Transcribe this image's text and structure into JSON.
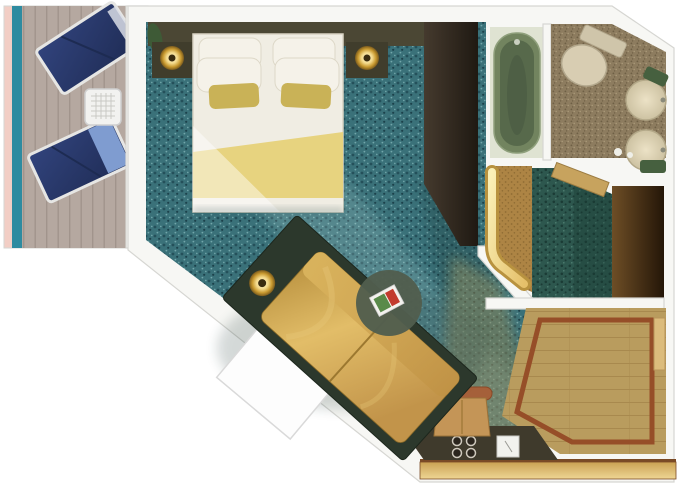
{
  "meta": {
    "title": "Cruise ship stateroom floor plan (top-down rendering)",
    "view": "top-down",
    "text_visible_in_image": ""
  },
  "areas": {
    "balcony": {
      "label": "Balcony",
      "items": [
        "lounge-chair",
        "lounge-chair",
        "mesh-side-table",
        "railing",
        "sliding-door"
      ]
    },
    "bedroom": {
      "label": "Bedroom",
      "items": [
        "double-bed",
        "pillows",
        "gold-runner",
        "nightstand-left",
        "nightstand-right",
        "lamp-left",
        "lamp-right",
        "plant",
        "wardrobe",
        "sofa",
        "side-lamp",
        "round-coffee-table",
        "magazine",
        "white-fold-panel"
      ]
    },
    "bathroom": {
      "label": "Bathroom",
      "items": [
        "bathtub",
        "toilet",
        "sink",
        "sink",
        "green-counter",
        "door-threshold"
      ]
    },
    "dressing": {
      "label": "Dressing area",
      "items": [
        "illuminated-closet",
        "dark-wardrobe"
      ]
    },
    "foyer": {
      "label": "Entry foyer",
      "items": [
        "wood-floor-inlay",
        "entry-door",
        "vanity-desk",
        "desk-chair",
        "cups",
        "note-card"
      ]
    }
  },
  "palette": {
    "wall-stroke": "#d6d6d2",
    "balcony-rail": "#f2cec5",
    "balcony-teal": "#2e8ba0",
    "deck": "#b5a8a0",
    "deck-line": "#a1948c",
    "lounger-navy": "#31437c",
    "lounger-navy-dark": "#1f2c55",
    "lounger-light": "#7f9cd0",
    "lounger-frame": "#e6e6e4",
    "table-white": "#f2f2f0",
    "table-grid": "#c9c9c5",
    "carpet-teal": "#3a7179",
    "carpet-dark": "#24505a",
    "carpet-dark2": "#1c424c",
    "carpet-light": "#72a6aa",
    "corridor-base": "#2d574e",
    "corridor-dark": "#1b3b35",
    "corridor-light": "#4f7f72",
    "headboard": "#4b4734",
    "nightstand": "#403d2c",
    "lamp-center": "#3a2c10",
    "bed-white": "#f0ede3",
    "bed-stroke": "#d9d4c4",
    "blanket-gold": "#e7d37f",
    "pillow-white": "#f5f2e9",
    "pillow-stroke": "#ddd8c8",
    "pillow-gold": "#c9b257",
    "plant": "#3e5a36",
    "wardrobe1-a": "#453a2e",
    "wardrobe1-b": "#1f1912",
    "sofa-base": "#2c382c",
    "table-round": "#515e4e",
    "magazine-red": "#c23b2e",
    "magazine-green": "#5a8a4a",
    "panel-white": "#fdfdfd",
    "panel-stroke": "#d9d9d9",
    "tub-room": "#dfe3d2",
    "tub-outer": "#72845f",
    "tub-inner": "#57694b",
    "tub-rim": "#8fa07c",
    "mosaic-base": "#8d7c5f",
    "mosaic-dark": "#6e5f45",
    "mosaic-light": "#a99877",
    "toilet-body": "#d8cdb2",
    "toilet-stroke": "#b2a78c",
    "sink-edge": "#b3a888",
    "counter-green": "#46603f",
    "threshold-wood": "#c7a35e",
    "threshold-edge": "#9c7c42",
    "closet-cork": "#ad8444",
    "closet-cork-dot": "#8f6c33",
    "wardrobe2-a": "#6e4e26",
    "wardrobe2-b": "#241608",
    "foyer-wood": "#b99c5e",
    "foyer-grain": "#a8894e",
    "inlay-red": "#964e28",
    "band-edge": "#7a4a26",
    "desk-dark": "#3f3a2c",
    "chair-seat": "#c49557",
    "chair-back": "#a5603a",
    "door-tan": "#dcbc7c",
    "door-tan-edge": "#b8955a",
    "cup-dark": "#2b251d",
    "cup-ring": "#cfc9bd",
    "beam-gold": "#d9b565",
    "beam-light": "#cfeeea",
    "shadow-dark": "#16312f"
  }
}
